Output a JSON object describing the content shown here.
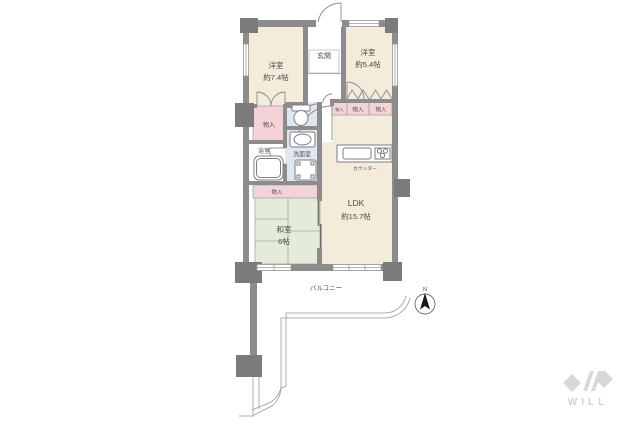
{
  "plan_type": "floor-plan",
  "rooms": {
    "genkan": {
      "label": "玄関"
    },
    "western1": {
      "label": "洋室",
      "size": "約7.4帖"
    },
    "western2": {
      "label": "洋室",
      "size": "約5.4帖"
    },
    "ldk": {
      "label": "LDK",
      "size": "約15.7帖"
    },
    "washitsu": {
      "label": "和室",
      "size": "6帖"
    },
    "bathroom": {
      "label": "浴室"
    },
    "washroom": {
      "label": "洗面室"
    },
    "balcony": {
      "label": "バルコニー"
    }
  },
  "labels": {
    "storage": "物入",
    "counter": "カウンター"
  },
  "compass": {
    "north": "N"
  },
  "branding": {
    "logo": "WILL"
  },
  "colors": {
    "wall": "#8c8c8c",
    "pillar": "#7b7b7b",
    "room_cream": "#f3ecda",
    "storage_pink": "#f4d3d8",
    "tatami_green": "#e4ebd9",
    "washroom_blue": "#e0e7f1",
    "line_gray": "#8a8a8a",
    "text": "#4a4a4a",
    "logo_gray": "#d8d8d8"
  }
}
